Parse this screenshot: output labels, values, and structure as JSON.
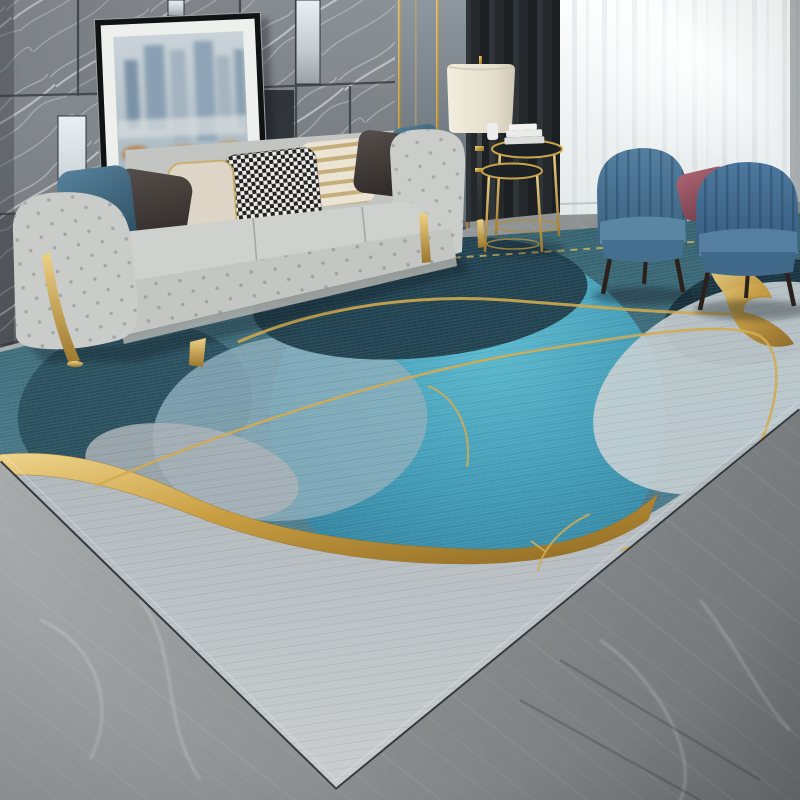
{
  "image_type": "photograph",
  "alt": "Product photo of a modern living room: an abstract blue, turquoise and grey area rug with gold ribbon accents lies on a grey marble floor in front of a light grey tufted chesterfield sofa with assorted pillows, a leaning framed abstract cityscape painting on a grey marble tile wall, a floor lamp with cream shade, gold nesting side tables, two blue velvet channel-tufted armchairs with a mauve accent pillow, and white sheer curtains.",
  "scene": {
    "setting": "modern luxury living room, daylight from right window",
    "objects": [
      {
        "name": "marble-tile-wall",
        "description": "large dark grey marble wall tiles with white diagonal veining and inset mirror strips",
        "colors": [
          "#6e7377",
          "#9aa0a5",
          "#e8edf0"
        ]
      },
      {
        "name": "gold-trim-panel-wall",
        "description": "grey wall panels with thin vertical brass trim strips",
        "colors": [
          "#8e979e",
          "#c99e42"
        ]
      },
      {
        "name": "dark-curtain",
        "description": "charcoal blackout curtain panel",
        "colors": [
          "#24282b"
        ]
      },
      {
        "name": "sheer-curtain",
        "description": "white translucent sheer curtain with soft vertical folds",
        "colors": [
          "#eef1f2",
          "#d3dadd"
        ]
      },
      {
        "name": "framed-cityscape-art",
        "description": "leaning black-framed abstract city skyline painting with white mat, muted blue towers and rust-orange smudges",
        "colors": [
          "#101214",
          "#eef0ed",
          "#8aa0b2",
          "#b97f43"
        ]
      },
      {
        "name": "tufted-sofa",
        "description": "light grey button-tufted chesterfield style sofa with curved gold metal legs",
        "colors": [
          "#c9cbc8",
          "#c99e42"
        ]
      },
      {
        "name": "sofa-pillows",
        "description": "pillows left to right: steel blue, charcoal brown, cream with gold trim, black-white houndstooth, cream-gold stripe, charcoal brown, steel blue",
        "colors": [
          "#4a7590",
          "#4c4643",
          "#ddd5c5",
          "#232323",
          "#c6ae7c",
          "#473f3d",
          "#4a7390"
        ]
      },
      {
        "name": "floor-lamp",
        "description": "floor lamp with cream drum shade and dark stem with brass rings",
        "colors": [
          "#e9e2d2",
          "#33373a",
          "#c99e42"
        ]
      },
      {
        "name": "nesting-side-tables",
        "description": "two round dark-top nesting tables with brass rims and legs, stacked white books on top",
        "colors": [
          "#1c2124",
          "#c99e42",
          "#ebebe9"
        ]
      },
      {
        "name": "armchairs",
        "description": "two blue velvet barrel armchairs with vertical channel tufting and dark tapered wood legs",
        "colors": [
          "#4a769c",
          "#2b211c"
        ]
      },
      {
        "name": "accent-pillow-mauve",
        "description": "dusty mauve velvet pillow on left armchair",
        "colors": [
          "#a05a66"
        ]
      },
      {
        "name": "area-rug",
        "description": "abstract modern rug: teal woven field, dark navy blobs, bright turquoise circle, pale blue and white stone shapes, grey foreground, thick gold foil ribbon and thin gold arcs with a dashed gold line",
        "colors": [
          "#3c6b78",
          "#1c3b49",
          "#3f9ab6",
          "#8badbb",
          "#c6cfd3",
          "#b3babd",
          "#c99e42"
        ]
      },
      {
        "name": "marble-floor",
        "description": "grey marble floor with diagonal veining, darker toward lower right",
        "colors": [
          "#aaadae",
          "#6f7375"
        ]
      }
    ]
  },
  "palette": {
    "page-bg": "#ffffff",
    "wall-gray": "#7a7f84",
    "gold": "#c99e42",
    "rug-teal": "#3c6b78",
    "rug-turquoise": "#3f9ab6",
    "rug-navy": "#1c3b49",
    "rug-gray": "#b3babd",
    "sofa-gray": "#c9cbc8",
    "armchair-blue": "#4a769c",
    "mauve": "#a05a66",
    "curtain-dark": "#24282b",
    "curtain-sheer": "#eef1f2",
    "floor-gray": "#8f9394",
    "lamp-shade": "#e9e2d2"
  }
}
